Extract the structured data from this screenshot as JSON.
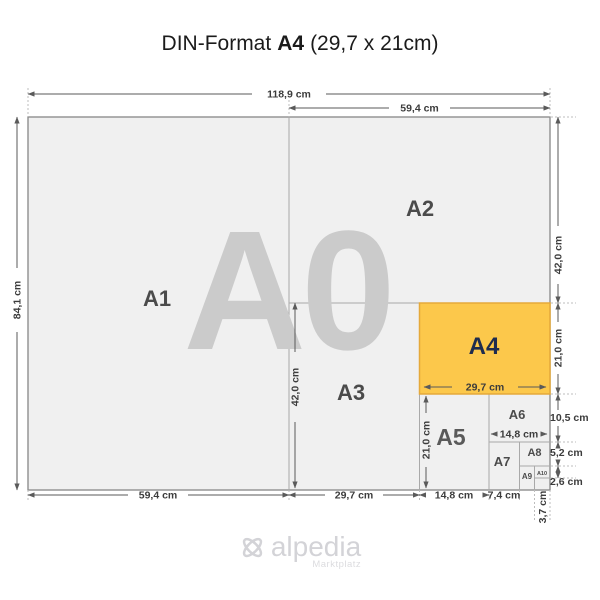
{
  "title": {
    "part1": "DIN-Format",
    "part2": "A4",
    "part3": "(29,7 x 21cm)"
  },
  "labels": {
    "a0": "A0",
    "a1": "A1",
    "a2": "A2",
    "a3": "A3",
    "a4": "A4",
    "a5": "A5",
    "a6": "A6",
    "a7": "A7",
    "a8": "A8",
    "a9": "A9",
    "a10": "A10"
  },
  "dims": {
    "a0_width": "118,9 cm",
    "a2_width_top": "59,4 cm",
    "a0_height": "84,1 cm",
    "a2_height": "42,0 cm",
    "a4_height": "21,0 cm",
    "a6_height": "10,5 cm",
    "a8_height": "5,2 cm",
    "a10_height": "2,6 cm",
    "a1_width": "59,4 cm",
    "a3_width": "29,7 cm",
    "a5_width": "14,8 cm",
    "a7_width": "7,4 cm",
    "a10_width": "3,7 cm",
    "a3_height_inner": "42,0 cm",
    "a5_height_inner": "21,0 cm",
    "a4_width_inner": "29,7 cm",
    "a6_width_inner": "14,8 cm"
  },
  "logo": {
    "brand": "alpedia",
    "tagline": "Marktplatz"
  },
  "colors": {
    "paper_fill": "#f0f0f0",
    "paper_border": "#8e8e8e",
    "inner_line": "#a9a9a9",
    "a4_fill": "#fcc84b",
    "a4_border": "#e5a93a",
    "a4_label": "#1f2c4e",
    "dim_line": "#5a5a5a",
    "guide": "#bdbdbd",
    "watermark": "#cbcbcb",
    "label": "#4b4b4b",
    "logo": "#d3d3d7",
    "logo_light": "#dcdcdf"
  }
}
